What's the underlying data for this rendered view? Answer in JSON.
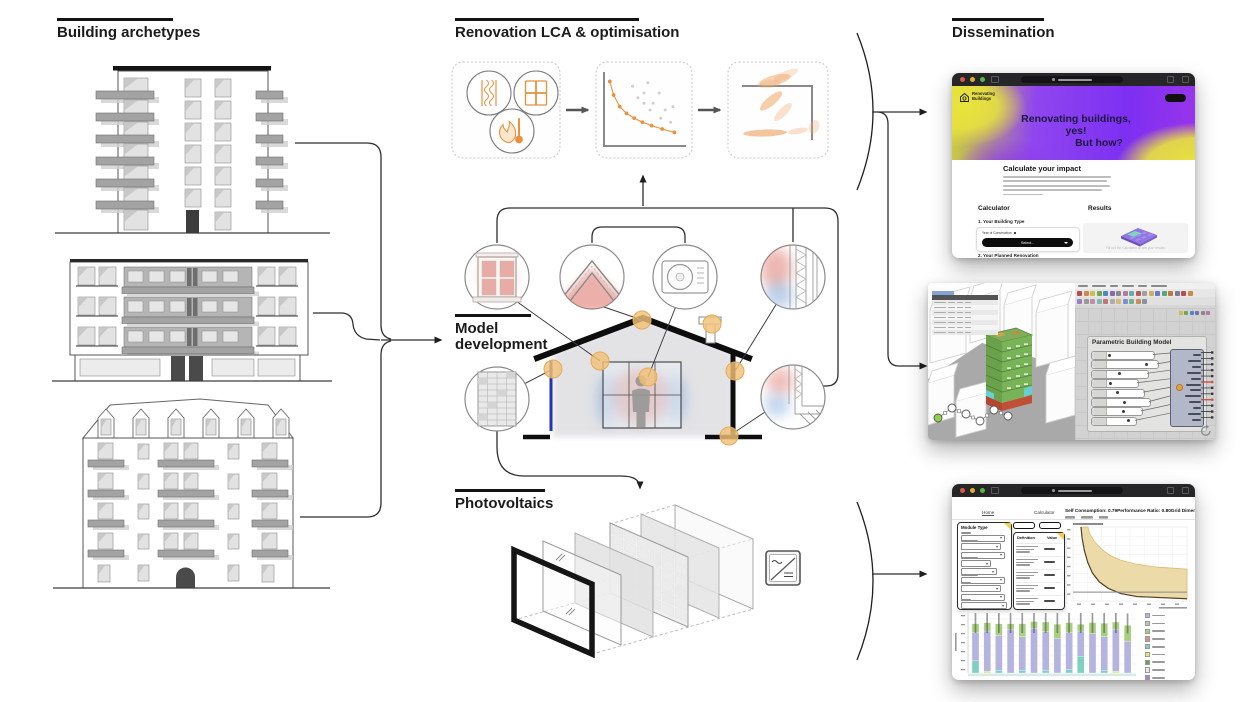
{
  "sections": {
    "building_archetypes": {
      "title": "Building archetypes"
    },
    "renovation_lca": {
      "title": "Renovation LCA & optimisation"
    },
    "model_development": {
      "title": "Model development"
    },
    "photovoltaics": {
      "title": "Photovoltaics"
    },
    "dissemination": {
      "title": "Dissemination"
    }
  },
  "website": {
    "logo": "Renovating Buildings",
    "hero_line1": "Renovating buildings,",
    "hero_line2": "yes!",
    "hero_line3": "But how?",
    "heading": "Calculate your impact",
    "calculator_label": "Calculator",
    "results_label": "Results",
    "step1": "1. Your Building Type",
    "field_label": "Year of Construction",
    "select_button": "Select...",
    "step2": "2. Your Planned Renovation",
    "results_placeholder": "Fill out the Calculator to see your results"
  },
  "rhino": {
    "gh_group_title": "Parametric Building Model",
    "slider_widths": [
      62,
      66,
      56,
      46,
      52,
      58,
      50,
      44
    ],
    "component_output_rows": 12,
    "red_output_rows": [
      5,
      8
    ]
  },
  "dashboard": {
    "tab_home": "Home",
    "tab_calculator": "Calculator",
    "module_type_label": "Module Type",
    "table_header_definition": "Definition",
    "table_header_value": "Value",
    "metrics": [
      {
        "label": "Self Consumption:",
        "value": "0.79"
      },
      {
        "label": "Performance Ratio:",
        "value": "0.80"
      },
      {
        "label": "Grid Dimensions:",
        "value": "0.28"
      }
    ]
  },
  "colors": {
    "accent_orange": "#e8913f",
    "amber_dot": "#f2c178",
    "heat_red": "#d96055",
    "cool_blue": "#7fa6d9",
    "pv_blue_strip": "#2233bb",
    "hero_purple": "#7d2ff2",
    "hero_yellow": "#e9e43c",
    "band_fill": "#ecd9a4",
    "band_edge": "#d9b96a",
    "band_curve": "#55402e",
    "gh_toolbar_chips": [
      "#b05050",
      "#d0884a",
      "#c8c050",
      "#74a850",
      "#5088c0",
      "#8868b8",
      "#888888",
      "#b878a0",
      "#60b0a8",
      "#c05858",
      "#a0a0a0",
      "#d0b060",
      "#6878c8",
      "#58a878",
      "#c07840",
      "#708090"
    ],
    "legend_colors": [
      "#b4b4de",
      "#c0c0c0",
      "#a6cf7e",
      "#d98f8a",
      "#7fd0c0",
      "#e4e478",
      "#6f9e54",
      "#e8e8e8",
      "#b07fd0"
    ]
  },
  "chart_data": [
    {
      "id": "pareto_optimisation_mini",
      "type": "scatter",
      "series": [
        {
          "name": "pareto-front",
          "points": [
            [
              0.05,
              0.92
            ],
            [
              0.1,
              0.72
            ],
            [
              0.18,
              0.55
            ],
            [
              0.27,
              0.45
            ],
            [
              0.37,
              0.38
            ],
            [
              0.48,
              0.32
            ],
            [
              0.6,
              0.27
            ],
            [
              0.74,
              0.22
            ],
            [
              0.9,
              0.17
            ]
          ]
        },
        {
          "name": "dominated-solutions",
          "points": [
            [
              0.35,
              0.85
            ],
            [
              0.5,
              0.75
            ],
            [
              0.55,
              0.9
            ],
            [
              0.62,
              0.6
            ],
            [
              0.7,
              0.75
            ],
            [
              0.78,
              0.5
            ],
            [
              0.58,
              0.5
            ],
            [
              0.72,
              0.38
            ],
            [
              0.85,
              0.32
            ],
            [
              0.5,
              0.6
            ],
            [
              0.88,
              0.55
            ],
            [
              0.42,
              0.68
            ]
          ]
        }
      ],
      "title": "",
      "xlabel": "",
      "ylabel": ""
    },
    {
      "id": "self_consumption_band",
      "type": "area",
      "band_upper": [
        [
          0.13,
          1
        ],
        [
          0.15,
          0.9
        ],
        [
          0.19,
          0.8
        ],
        [
          0.25,
          0.7
        ],
        [
          0.32,
          0.62
        ],
        [
          0.42,
          0.55
        ],
        [
          0.55,
          0.5
        ],
        [
          0.72,
          0.46
        ],
        [
          1,
          0.43
        ]
      ],
      "band_lower": [
        [
          0.07,
          1
        ],
        [
          0.08,
          0.85
        ],
        [
          0.1,
          0.68
        ],
        [
          0.13,
          0.52
        ],
        [
          0.17,
          0.38
        ],
        [
          0.23,
          0.26
        ],
        [
          0.31,
          0.17
        ],
        [
          0.42,
          0.1
        ],
        [
          0.56,
          0.06
        ],
        [
          1,
          0.03
        ]
      ],
      "hline": 0.12,
      "grid": true
    },
    {
      "id": "lca_stacked_bars",
      "type": "bar",
      "stacked": true,
      "segment_order": [
        "yellow",
        "teal",
        "lavender",
        "green"
      ],
      "segment_colors": {
        "teal": "#7fd0c0",
        "lavender": "#b4b4de",
        "green": "#a6cf7e",
        "yellow": "#e4e478"
      },
      "bars": [
        {
          "teal": 0.22,
          "lavender": 0.5,
          "green": 0.16
        },
        {
          "yellow": 0.03,
          "lavender": 0.72,
          "green": 0.15
        },
        {
          "teal": 0.05,
          "lavender": 0.62,
          "green": 0.21
        },
        {
          "lavender": 0.78,
          "green": 0.1
        },
        {
          "teal": 0.05,
          "lavender": 0.6,
          "green": 0.23
        },
        {
          "lavender": 0.8,
          "green": 0.12
        },
        {
          "teal": 0.04,
          "lavender": 0.7,
          "green": 0.17
        },
        {
          "lavender": 0.62,
          "green": 0.25
        },
        {
          "teal": 0.06,
          "lavender": 0.66,
          "green": 0.18
        },
        {
          "teal": 0.3,
          "lavender": 0.45,
          "green": 0.12
        },
        {
          "lavender": 0.7,
          "green": 0.2
        },
        {
          "teal": 0.05,
          "lavender": 0.6,
          "green": 0.24
        },
        {
          "yellow": 0.03,
          "lavender": 0.75,
          "green": 0.13
        },
        {
          "lavender": 0.57,
          "green": 0.28
        }
      ]
    }
  ]
}
